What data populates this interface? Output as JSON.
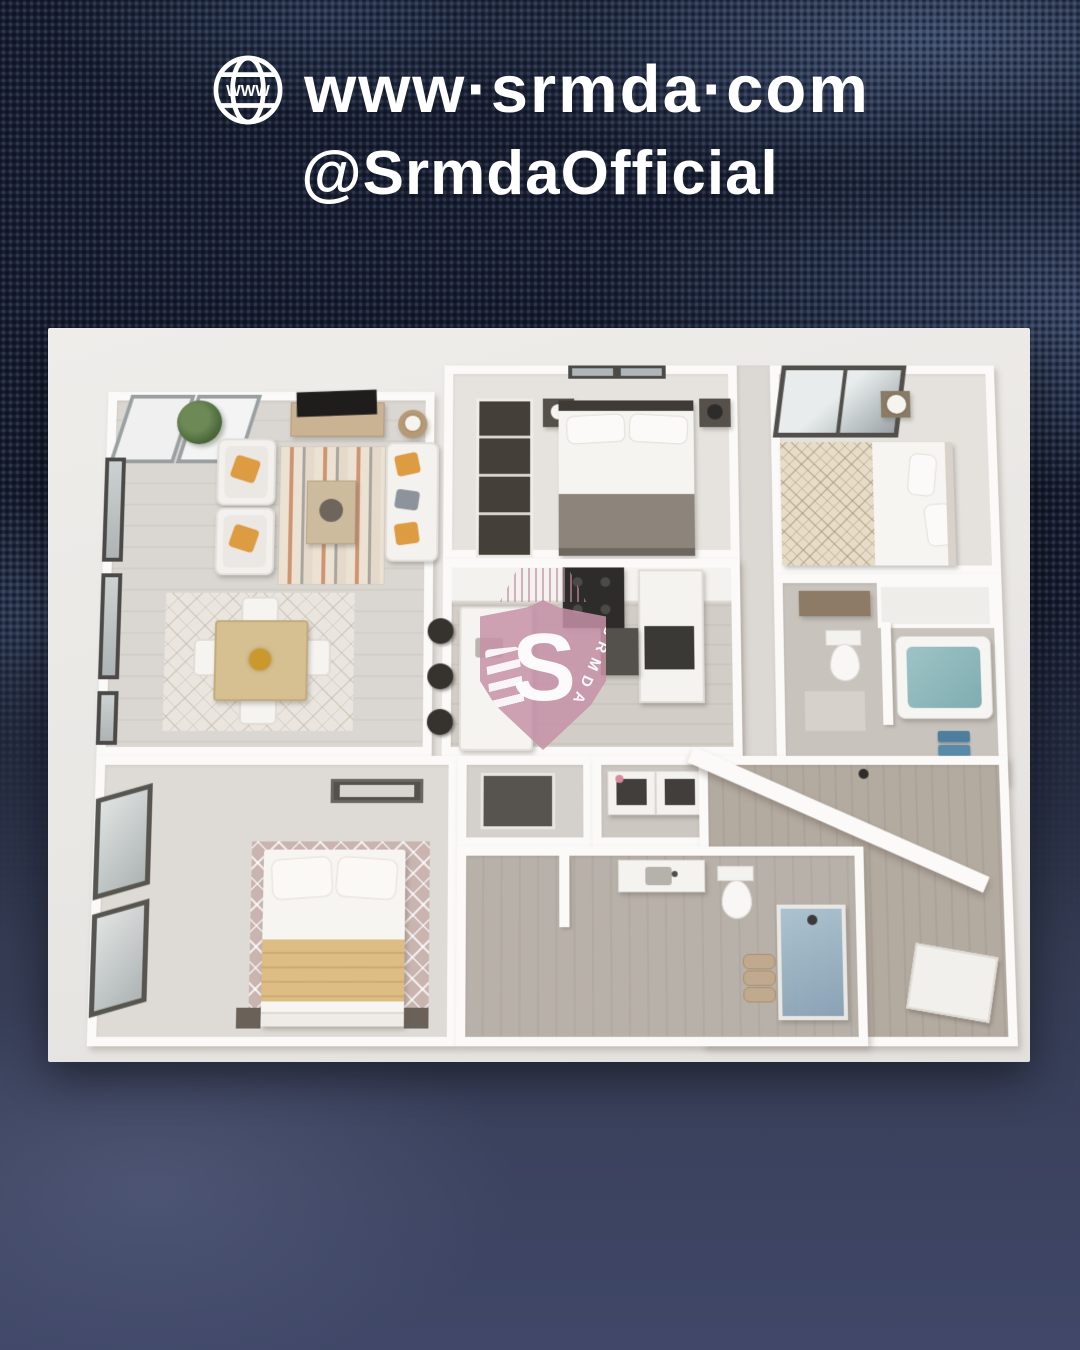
{
  "post": {
    "header": {
      "icon": "globe-www-icon",
      "website": "www.srmda.com",
      "website_display": "www·srmda·com",
      "handle": "@SrmdaOfficial",
      "text_color": "#ffffff"
    },
    "background": {
      "description": "dark navy woven fabric texture with sheen, smooth blurred navy at bottom",
      "base_color": "#181f31",
      "sheen_color": "#7d9bcd",
      "bottom_color": "#3c4360"
    },
    "photo": {
      "description": "3D rendered top-view apartment floor plan",
      "background_color": "#eceae7",
      "wall_color": "#fbfaf8",
      "colors": {
        "floor_light": "#d8d4cf",
        "carpet": "#e5e2dd",
        "wood_floor": "#b3aaa0",
        "tile": "#c8c3bd",
        "pillow_accent": "#dd9b42",
        "blanket_gold": "#ddbd83",
        "blanket_gray": "#8d857c",
        "tub_water": "#8ab5b8",
        "towel_blue": "#4d7e9d",
        "shower_glass": "#aac5d6",
        "rug_mauve": "#c9b4b0",
        "wood_furniture": "#c9b392",
        "dark_fixture": "#3b3936"
      },
      "rooms": [
        {
          "name": "living-room",
          "contents": [
            "two white armchairs with orange pillows",
            "white sofa with orange and gray pillows",
            "striped rug",
            "wood coffee table",
            "tv console with tv",
            "side table with lamp",
            "potted plant",
            "black-framed windows"
          ]
        },
        {
          "name": "dining-area",
          "contents": [
            "square wood table",
            "four white chairs",
            "lattice rug",
            "gold centerpiece"
          ]
        },
        {
          "name": "master-bedroom",
          "contents": [
            "double bed with gray foot blanket",
            "two dark nightstands",
            "lamps",
            "dark wardrobe",
            "window"
          ]
        },
        {
          "name": "bedroom-2",
          "contents": [
            "bed with diamond-pattern cream blanket",
            "wood nightstand",
            "white lamp",
            "large corner window"
          ]
        },
        {
          "name": "bathroom-1",
          "contents": [
            "toilet",
            "bathtub with teal water",
            "wood vanity",
            "blue towels",
            "linen alcove"
          ]
        },
        {
          "name": "kitchen",
          "contents": [
            "island with sink",
            "three dark bar stools",
            "dark range",
            "tall counter with fridge"
          ]
        },
        {
          "name": "bedroom-3",
          "contents": [
            "bed with gold blanket",
            "mauve lattice rug",
            "sliding-door closet",
            "ceiling light",
            "slanted windows"
          ]
        },
        {
          "name": "laundry",
          "contents": [
            "washer",
            "dryer"
          ]
        },
        {
          "name": "bathroom-2",
          "contents": [
            "vanity with sink",
            "toilet",
            "blue glass shower",
            "rolled towels"
          ]
        },
        {
          "name": "entry-hall",
          "contents": [
            "wood plank floor",
            "white door mat",
            "diagonal wall"
          ]
        }
      ]
    },
    "watermark": {
      "letter": "S",
      "label": "SRMDA",
      "shield_color": "#c590a7",
      "text_color": "#ffffff"
    }
  }
}
